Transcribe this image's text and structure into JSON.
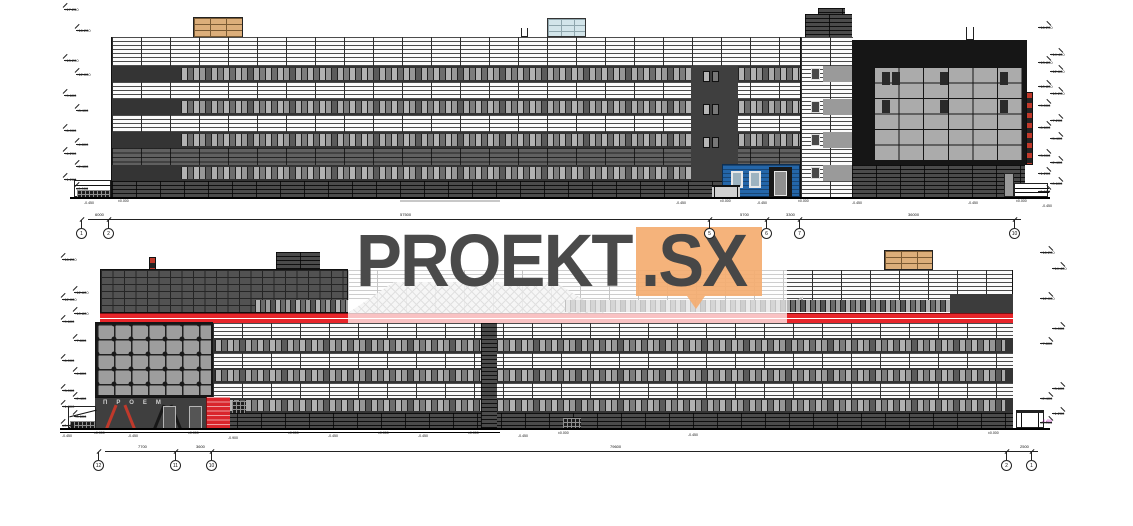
{
  "watermark": {
    "word": "PROEKT",
    "suffix": ".SX",
    "orange": "#F4AC70",
    "text_color": "#4A4A4A"
  },
  "colors": {
    "accent_red": "#E8252A",
    "entry_blue": "#2466A9",
    "roof_tan": "#DCAE7A",
    "roof_lightblue": "#D3E5EA",
    "black_volume": "#161616"
  },
  "signage": {
    "text": "ПРОЕМ"
  },
  "levels": {
    "top_left": [
      {
        "y": 8,
        "l": "+17.250"
      },
      {
        "y": 29,
        "l": "+16.200"
      },
      {
        "y": 59,
        "l": "+13.200"
      },
      {
        "y": 73,
        "l": "+12.000"
      },
      {
        "y": 94,
        "l": "+9.600"
      },
      {
        "y": 109,
        "l": "+8.400"
      },
      {
        "y": 129,
        "l": "+6.000"
      },
      {
        "y": 143,
        "l": "+4.800"
      },
      {
        "y": 152,
        "l": "+4.200"
      },
      {
        "y": 165,
        "l": "+2.400"
      },
      {
        "y": 178,
        "l": "+1.200"
      },
      {
        "y": 187,
        "l": "±0.000"
      }
    ],
    "top_right": [
      {
        "y": 26,
        "l": "+16.200"
      },
      {
        "y": 53,
        "l": "+14.400"
      },
      {
        "y": 61,
        "l": "+13.800"
      },
      {
        "y": 70,
        "l": "+12.600"
      },
      {
        "y": 85,
        "l": "+10.800"
      },
      {
        "y": 92,
        "l": "+10.200"
      },
      {
        "y": 104,
        "l": "+9.000"
      },
      {
        "y": 119,
        "l": "+7.200"
      },
      {
        "y": 126,
        "l": "+6.600"
      },
      {
        "y": 137,
        "l": "+5.400"
      },
      {
        "y": 154,
        "l": "+3.000"
      },
      {
        "y": 161,
        "l": "+2.400"
      },
      {
        "y": 172,
        "l": "+1.200"
      },
      {
        "y": 182,
        "l": "+0.600"
      },
      {
        "y": 190,
        "l": "±0.000"
      }
    ],
    "bottom_left": [
      {
        "y": 258,
        "l": "+16.200"
      },
      {
        "y": 291,
        "l": "+12.600"
      },
      {
        "y": 298,
        "l": "+12.000"
      },
      {
        "y": 312,
        "l": "+10.800"
      },
      {
        "y": 320,
        "l": "+9.600"
      },
      {
        "y": 339,
        "l": "+7.800"
      },
      {
        "y": 359,
        "l": "+6.000"
      },
      {
        "y": 372,
        "l": "+4.800"
      },
      {
        "y": 389,
        "l": "+3.000"
      },
      {
        "y": 397,
        "l": "+2.400"
      },
      {
        "y": 405,
        "l": "+1.800"
      },
      {
        "y": 415,
        "l": "+0.600"
      },
      {
        "y": 424,
        "l": "±0.000"
      }
    ],
    "bottom_right": [
      {
        "y": 251,
        "l": "+16.200"
      },
      {
        "y": 267,
        "l": "+14.400"
      },
      {
        "y": 297,
        "l": "+12.000"
      },
      {
        "y": 327,
        "l": "+9.000"
      },
      {
        "y": 342,
        "l": "+7.800"
      },
      {
        "y": 387,
        "l": "+3.600"
      },
      {
        "y": 397,
        "l": "+2.400"
      },
      {
        "y": 412,
        "l": "+1.200"
      },
      {
        "y": 421,
        "l": "±0.000"
      }
    ],
    "magenta_note": {
      "x": 1042,
      "y": 419,
      "l": "-0.450",
      "c": "#C433C4"
    }
  },
  "axes": {
    "top": [
      {
        "x": 82,
        "l": "1"
      },
      {
        "x": 109,
        "l": "2"
      },
      {
        "x": 710,
        "l": "5"
      },
      {
        "x": 767,
        "l": "6"
      },
      {
        "x": 800,
        "l": "7"
      },
      {
        "x": 1015,
        "l": "10"
      }
    ],
    "bottom": [
      {
        "x": 99,
        "l": "12"
      },
      {
        "x": 176,
        "l": "11"
      },
      {
        "x": 212,
        "l": "10"
      },
      {
        "x": 1007,
        "l": "2"
      },
      {
        "x": 1032,
        "l": "1"
      }
    ]
  },
  "dimensions": {
    "top": [
      {
        "x": 95,
        "l": "6000"
      },
      {
        "x": 400,
        "l": "57500"
      },
      {
        "x": 740,
        "l": "5700"
      },
      {
        "x": 786,
        "l": "3300"
      },
      {
        "x": 908,
        "l": "36000"
      }
    ],
    "bottom": [
      {
        "x": 138,
        "l": "7700"
      },
      {
        "x": 196,
        "l": "3600"
      },
      {
        "x": 610,
        "l": "79600"
      },
      {
        "x": 1020,
        "l": "2500"
      }
    ]
  },
  "micro_notes": {
    "top": [
      {
        "x": 84,
        "y": 201,
        "l": "-0.450"
      },
      {
        "x": 118,
        "y": 199,
        "l": "±0.000"
      },
      {
        "x": 676,
        "y": 201,
        "l": "-0.450"
      },
      {
        "x": 720,
        "y": 199,
        "l": "±0.000"
      },
      {
        "x": 757,
        "y": 201,
        "l": "-0.450"
      },
      {
        "x": 798,
        "y": 199,
        "l": "±0.000"
      },
      {
        "x": 852,
        "y": 201,
        "l": "-0.450"
      },
      {
        "x": 968,
        "y": 201,
        "l": "-0.450"
      },
      {
        "x": 1016,
        "y": 199,
        "l": "±0.000"
      },
      {
        "x": 1042,
        "y": 204,
        "l": "-0.450"
      }
    ],
    "bottom": [
      {
        "x": 62,
        "y": 434,
        "l": "-0.450"
      },
      {
        "x": 94,
        "y": 431,
        "l": "±0.000"
      },
      {
        "x": 128,
        "y": 434,
        "l": "-0.450"
      },
      {
        "x": 188,
        "y": 431,
        "l": "±0.000"
      },
      {
        "x": 228,
        "y": 436,
        "l": "-0.900"
      },
      {
        "x": 288,
        "y": 431,
        "l": "±0.000"
      },
      {
        "x": 328,
        "y": 434,
        "l": "-0.450"
      },
      {
        "x": 378,
        "y": 431,
        "l": "±0.000"
      },
      {
        "x": 418,
        "y": 434,
        "l": "-0.450"
      },
      {
        "x": 468,
        "y": 431,
        "l": "±0.000"
      },
      {
        "x": 518,
        "y": 434,
        "l": "-0.450"
      },
      {
        "x": 558,
        "y": 431,
        "l": "±0.000"
      },
      {
        "x": 688,
        "y": 433,
        "l": "-0.450"
      },
      {
        "x": 988,
        "y": 431,
        "l": "±0.000"
      }
    ]
  }
}
